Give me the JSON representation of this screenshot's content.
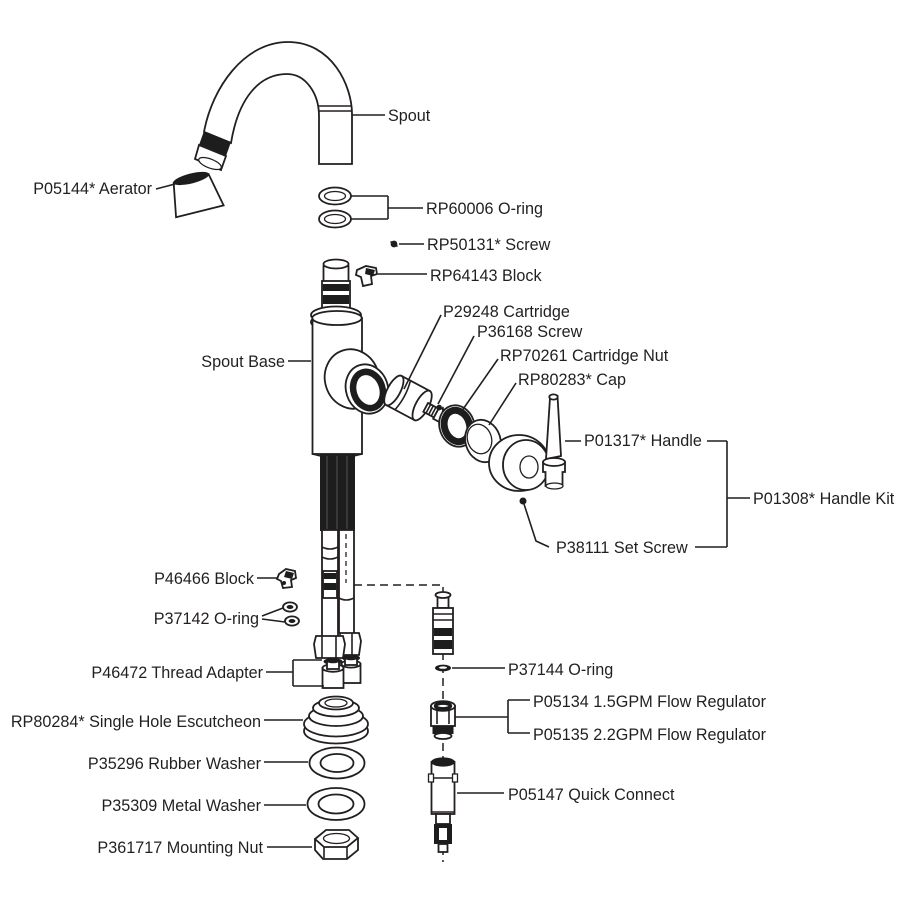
{
  "diagram": {
    "type": "exploded-parts-diagram",
    "subject": "single-handle faucet parts breakdown",
    "colors": {
      "line": "#231f20",
      "background": "#ffffff"
    },
    "labels": {
      "spout": "Spout",
      "aerator": "P05144* Aerator",
      "oring_top": "RP60006 O-ring",
      "screw_top": "RP50131* Screw",
      "block_top": "RP64143 Block",
      "cartridge": "P29248 Cartridge",
      "screw_mid": "P36168 Screw",
      "cartridge_nut": "RP70261 Cartridge Nut",
      "cap": "RP80283* Cap",
      "spout_base": "Spout Base",
      "handle": "P01317* Handle",
      "handle_kit": "P01308* Handle Kit",
      "set_screw": "P38111 Set Screw",
      "block_bottom": "P46466 Block",
      "oring_mid": "P37142 O-ring",
      "thread_adapter": "P46472 Thread Adapter",
      "escutcheon": "RP80284* Single Hole Escutcheon",
      "rubber_washer": "P35296 Rubber Washer",
      "metal_washer": "P35309 Metal Washer",
      "mounting_nut": "P361717 Mounting Nut",
      "oring_small": "P37144 O-ring",
      "flow_regulator_15": "P05134 1.5GPM Flow Regulator",
      "flow_regulator_22": "P05135 2.2GPM Flow Regulator",
      "quick_connect": "P05147 Quick Connect"
    }
  }
}
